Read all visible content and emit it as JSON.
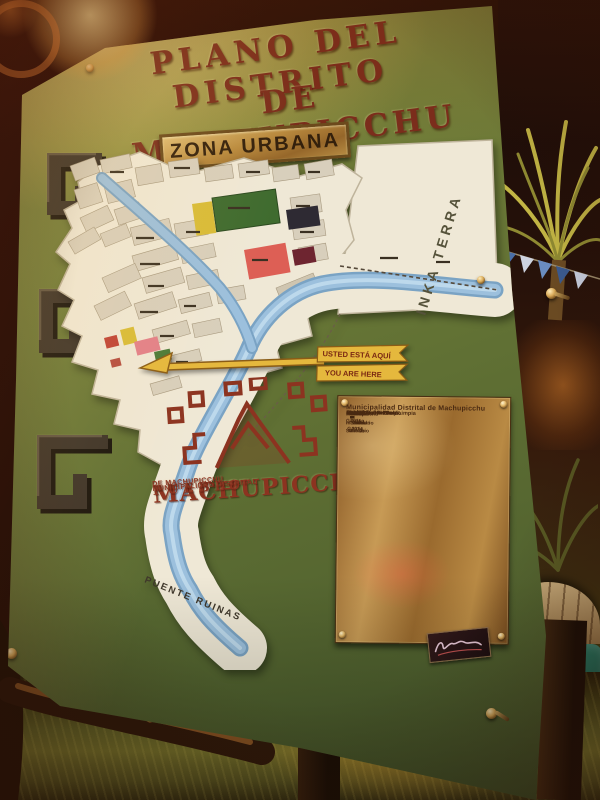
{
  "board": {
    "title_line1": "PLANO DEL DISTRITO",
    "title_line2": "DE MACHUPICCHU",
    "zona_urbana": "ZONA URBANA"
  },
  "map": {
    "arrow": {
      "line1": "USTED ESTÁ AQUÍ",
      "line2": "YOU ARE HERE"
    },
    "labels": {
      "inka_terra": "INKA  TERRA",
      "puente_ruinas": "PUENTE RUINAS"
    }
  },
  "logo": {
    "name": "MACHUPICCHU",
    "subname": "PUEBLO",
    "org_line1": "MUNICIPALIDAD DISTRITAL",
    "org_line2": "DE MACHUPICCHU"
  },
  "plaque": {
    "title": "Municipalidad Distrital de Machupicchu",
    "slogan_es": [
      "Machupicchu Pueblo",
      "Ciudad Sol del Perú",
      "Segura Ordenada y Limpia"
    ],
    "slogan_en": [
      "Machupicchu Town",
      "Sun City of Peru",
      "Safe Tidy and Clean"
    ],
    "directory_row_count": 17,
    "footer_left": [
      "Machupicchu Pueblo",
      "Antesala al Santuario",
      "2050 m.s.n.m."
    ],
    "footer_right": [
      "Machupicchu Santuario",
      "Maravilla del Mundo",
      "2400 m.s.n.m."
    ],
    "footer_center": [
      "GESTIÓN 2011 - 2014",
      "David Gayoso García",
      "ALCALDE"
    ]
  },
  "colors": {
    "board_green": "#617134",
    "title_maroon": "#7b2d1c",
    "plaque_bronze": "#b98a44",
    "river_blue": "#9cc0dd",
    "arrow_yellow": "#e5b83d",
    "map_white": "#efe8d6"
  }
}
